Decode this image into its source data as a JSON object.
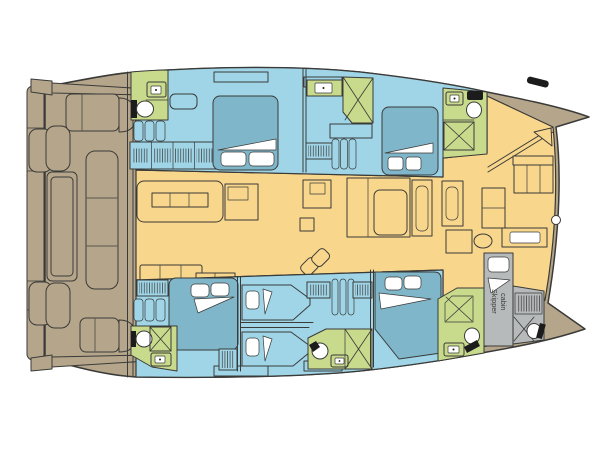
{
  "meta": {
    "type": "floor-plan",
    "subject": "Catamaran interior layout deck plan, bow pointing right"
  },
  "labels": {
    "skipper_cabin": "Skipper cabin",
    "skipper_line1": "Skipper",
    "skipper_line2": "cabin"
  },
  "colors": {
    "background": "#ffffff",
    "outline": "#3a3a38",
    "hull_tan": "#b5a68b",
    "cabin_blue": "#9fd5e7",
    "bed_blue": "#7fb6c9",
    "bath_green": "#c8da8c",
    "salon_yellow": "#f8d78d",
    "skipper_gray": "#b6baba",
    "pillow_white": "#ffffff",
    "fixture_black": "#1c1c1c"
  },
  "rooms": [
    "swim-platform",
    "aft-cockpit",
    "salon-galley",
    "foredeck",
    "port-aft-bathroom",
    "port-aft-cabin",
    "port-forward-cabin",
    "port-forward-shower",
    "port-forward-bathroom",
    "starboard-aft-cabin",
    "starboard-aft-bathroom",
    "starboard-mid-cabin-upper",
    "starboard-mid-cabin-lower",
    "starboard-mid-bathroom",
    "starboard-forward-cabin",
    "starboard-forward-bathroom",
    "skipper-cabin",
    "skipper-bathroom"
  ],
  "fixtures": [
    "double-bed",
    "single-bed",
    "pillow",
    "blanket-fold",
    "toilet",
    "sink",
    "shower",
    "hanging-locker",
    "stairs",
    "sofa",
    "galley-island",
    "dining-table",
    "davit-platform",
    "targa-bar",
    "cleat",
    "winch"
  ]
}
